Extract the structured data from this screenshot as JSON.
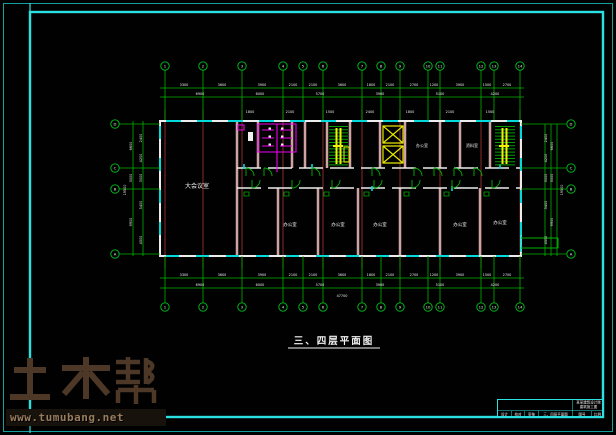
{
  "caption": "三、四层平面图",
  "watermark": {
    "logo": "土木帮",
    "url": "www.tumubang.net"
  },
  "colors": {
    "frame_cyan": "#2be0e0",
    "window_cyan": "#00dada",
    "dim_green": "#00b400",
    "hatch_green": "#00a000",
    "axis_red": "#8b2b2b",
    "wall_pink": "#cfa3a3",
    "wall_white": "#ececec",
    "fixture_magenta": "#ee00ee",
    "stair_yellow": "#f0f000",
    "watermark_brown": "#4d3827"
  },
  "axes": {
    "top": [
      "1",
      "2",
      "3",
      "4",
      "5",
      "6",
      "7",
      "8",
      "9",
      "10",
      "11",
      "12",
      "13",
      "14"
    ],
    "bottom": [
      "1",
      "2",
      "3",
      "4",
      "5",
      "6",
      "7",
      "8",
      "9",
      "10",
      "11",
      "12",
      "13",
      "14"
    ],
    "left": [
      "D",
      "C",
      "B",
      "A"
    ],
    "right": [
      "D",
      "C",
      "B",
      "A"
    ]
  },
  "dims": {
    "top_row1": [
      "3300",
      "3600",
      "3900",
      "2100",
      "2100",
      "3600",
      "1800",
      "2100",
      "2700",
      "1200",
      "3900",
      "1500",
      "2700"
    ],
    "top_row2": [
      "6900",
      "6000",
      "5700",
      "3900",
      "5100",
      "4200"
    ],
    "top_row3": [
      "1800",
      "2100",
      "1500",
      "2400",
      "1800",
      "2100",
      "1500"
    ],
    "bottom_row1": [
      "3300",
      "3600",
      "3900",
      "2100",
      "2100",
      "3600",
      "1800",
      "2100",
      "2700",
      "1200",
      "3900",
      "1500",
      "2700"
    ],
    "bottom_row2": [
      "6900",
      "6000",
      "5700",
      "3900",
      "5100",
      "4200"
    ],
    "bottom_total": "47700",
    "left_inner": [
      "2400",
      "4200",
      "3000",
      "5400",
      "4500"
    ],
    "left_outer": [
      "6600",
      "3000",
      "9900"
    ],
    "left_total": "19500",
    "right_inner": [
      "2400",
      "4200",
      "3000",
      "5400",
      "4500"
    ],
    "right_outer": [
      "6600",
      "3000",
      "9900"
    ],
    "right_total": "19500"
  },
  "rooms": {
    "hall": "大会议室",
    "office1": "办公室",
    "office2": "办公室",
    "office3": "办公室",
    "office4": "办公室",
    "office5": "办公室",
    "upper1": "办公室",
    "upper2": "资料室"
  },
  "title_block": {
    "company": "某某建筑设计院",
    "project": "建筑施工图",
    "c1": "设计",
    "c2": "校对",
    "c3": "审核",
    "c4": "三、四层平面图",
    "c5": "图号",
    "c6": "比例"
  }
}
